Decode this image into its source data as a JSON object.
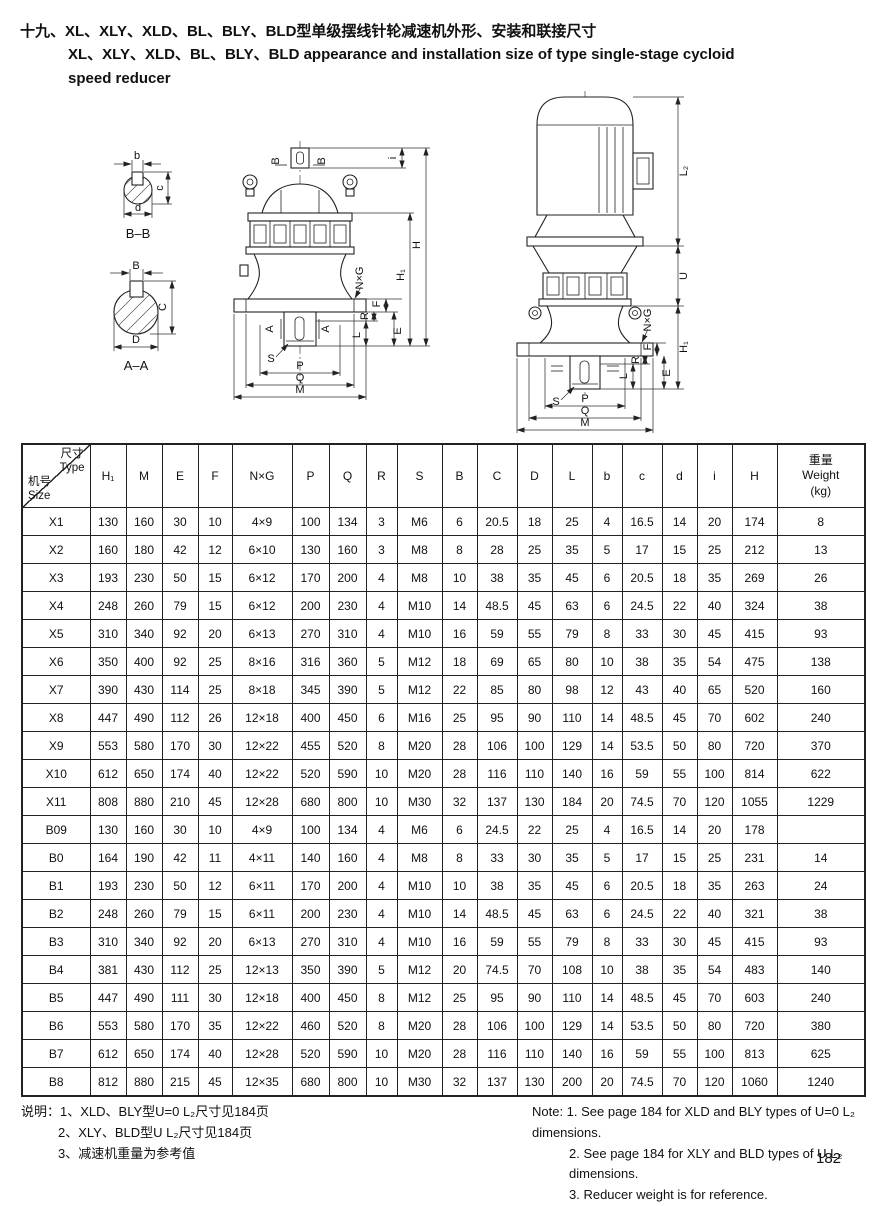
{
  "page": {
    "number": "182"
  },
  "title": {
    "zh": "十九、XL、XLY、XLD、BL、BLY、BLD型单级摆线针轮减速机外形、安装和联接尺寸",
    "en_line1": "XL、XLY、XLD、BL、BLY、BLD appearance and installation size of type single-stage cycloid",
    "en_line2": "speed reducer"
  },
  "drawings": {
    "bb_section": {
      "caption": "B–B",
      "dim_b": "b",
      "dim_c": "c",
      "dim_d": "d"
    },
    "aa_section": {
      "caption": "A–A",
      "dim_b": "B",
      "dim_c": "C",
      "dim_d": "D"
    },
    "reducer": {
      "mark_b": "B",
      "mark_a": "A",
      "dim_i": "i",
      "dim_h": "H",
      "dim_h1": "H₁",
      "dim_nxg": "N×G",
      "dim_f": "F",
      "dim_r": "R",
      "dim_e": "E",
      "dim_l": "L",
      "dim_s": "S",
      "dim_p": "P",
      "dim_q": "Q",
      "dim_m": "M"
    },
    "motor_reducer": {
      "dim_l2": "L₂",
      "dim_u": "U",
      "dim_h1": "H₁",
      "dim_nxg": "N×G",
      "dim_f": "F",
      "dim_r": "R",
      "dim_e": "E",
      "dim_l": "L",
      "dim_s": "S",
      "dim_p": "P",
      "dim_q": "Q",
      "dim_m": "M"
    }
  },
  "table": {
    "corner": {
      "top_zh": "尺寸",
      "top_en": "Type",
      "bottom_zh": "机号",
      "bottom_en": "Size"
    },
    "columns": [
      "H₁",
      "M",
      "E",
      "F",
      "N×G",
      "P",
      "Q",
      "R",
      "S",
      "B",
      "C",
      "D",
      "L",
      "b",
      "c",
      "d",
      "i",
      "H"
    ],
    "weight_header": [
      "重量",
      "Weight",
      "(kg)"
    ],
    "rows": [
      {
        "type": "X1",
        "values": [
          "130",
          "160",
          "30",
          "10",
          "4×9",
          "100",
          "134",
          "3",
          "M6",
          "6",
          "20.5",
          "18",
          "25",
          "4",
          "16.5",
          "14",
          "20",
          "174",
          "8"
        ]
      },
      {
        "type": "X2",
        "values": [
          "160",
          "180",
          "42",
          "12",
          "6×10",
          "130",
          "160",
          "3",
          "M8",
          "8",
          "28",
          "25",
          "35",
          "5",
          "17",
          "15",
          "25",
          "212",
          "13"
        ]
      },
      {
        "type": "X3",
        "values": [
          "193",
          "230",
          "50",
          "15",
          "6×12",
          "170",
          "200",
          "4",
          "M8",
          "10",
          "38",
          "35",
          "45",
          "6",
          "20.5",
          "18",
          "35",
          "269",
          "26"
        ]
      },
      {
        "type": "X4",
        "values": [
          "248",
          "260",
          "79",
          "15",
          "6×12",
          "200",
          "230",
          "4",
          "M10",
          "14",
          "48.5",
          "45",
          "63",
          "6",
          "24.5",
          "22",
          "40",
          "324",
          "38"
        ]
      },
      {
        "type": "X5",
        "values": [
          "310",
          "340",
          "92",
          "20",
          "6×13",
          "270",
          "310",
          "4",
          "M10",
          "16",
          "59",
          "55",
          "79",
          "8",
          "33",
          "30",
          "45",
          "415",
          "93"
        ]
      },
      {
        "type": "X6",
        "values": [
          "350",
          "400",
          "92",
          "25",
          "8×16",
          "316",
          "360",
          "5",
          "M12",
          "18",
          "69",
          "65",
          "80",
          "10",
          "38",
          "35",
          "54",
          "475",
          "138"
        ]
      },
      {
        "type": "X7",
        "values": [
          "390",
          "430",
          "114",
          "25",
          "8×18",
          "345",
          "390",
          "5",
          "M12",
          "22",
          "85",
          "80",
          "98",
          "12",
          "43",
          "40",
          "65",
          "520",
          "160"
        ]
      },
      {
        "type": "X8",
        "values": [
          "447",
          "490",
          "112",
          "26",
          "12×18",
          "400",
          "450",
          "6",
          "M16",
          "25",
          "95",
          "90",
          "110",
          "14",
          "48.5",
          "45",
          "70",
          "602",
          "240"
        ]
      },
      {
        "type": "X9",
        "values": [
          "553",
          "580",
          "170",
          "30",
          "12×22",
          "455",
          "520",
          "8",
          "M20",
          "28",
          "106",
          "100",
          "129",
          "14",
          "53.5",
          "50",
          "80",
          "720",
          "370"
        ]
      },
      {
        "type": "X10",
        "values": [
          "612",
          "650",
          "174",
          "40",
          "12×22",
          "520",
          "590",
          "10",
          "M20",
          "28",
          "116",
          "110",
          "140",
          "16",
          "59",
          "55",
          "100",
          "814",
          "622"
        ]
      },
      {
        "type": "X11",
        "values": [
          "808",
          "880",
          "210",
          "45",
          "12×28",
          "680",
          "800",
          "10",
          "M30",
          "32",
          "137",
          "130",
          "184",
          "20",
          "74.5",
          "70",
          "120",
          "1055",
          "1229"
        ]
      },
      {
        "type": "B09",
        "values": [
          "130",
          "160",
          "30",
          "10",
          "4×9",
          "100",
          "134",
          "4",
          "M6",
          "6",
          "24.5",
          "22",
          "25",
          "4",
          "16.5",
          "14",
          "20",
          "178",
          ""
        ]
      },
      {
        "type": "B0",
        "values": [
          "164",
          "190",
          "42",
          "11",
          "4×11",
          "140",
          "160",
          "4",
          "M8",
          "8",
          "33",
          "30",
          "35",
          "5",
          "17",
          "15",
          "25",
          "231",
          "14"
        ]
      },
      {
        "type": "B1",
        "values": [
          "193",
          "230",
          "50",
          "12",
          "6×11",
          "170",
          "200",
          "4",
          "M10",
          "10",
          "38",
          "35",
          "45",
          "6",
          "20.5",
          "18",
          "35",
          "263",
          "24"
        ]
      },
      {
        "type": "B2",
        "values": [
          "248",
          "260",
          "79",
          "15",
          "6×11",
          "200",
          "230",
          "4",
          "M10",
          "14",
          "48.5",
          "45",
          "63",
          "6",
          "24.5",
          "22",
          "40",
          "321",
          "38"
        ]
      },
      {
        "type": "B3",
        "values": [
          "310",
          "340",
          "92",
          "20",
          "6×13",
          "270",
          "310",
          "4",
          "M10",
          "16",
          "59",
          "55",
          "79",
          "8",
          "33",
          "30",
          "45",
          "415",
          "93"
        ]
      },
      {
        "type": "B4",
        "values": [
          "381",
          "430",
          "112",
          "25",
          "12×13",
          "350",
          "390",
          "5",
          "M12",
          "20",
          "74.5",
          "70",
          "108",
          "10",
          "38",
          "35",
          "54",
          "483",
          "140"
        ]
      },
      {
        "type": "B5",
        "values": [
          "447",
          "490",
          "111",
          "30",
          "12×18",
          "400",
          "450",
          "8",
          "M12",
          "25",
          "95",
          "90",
          "110",
          "14",
          "48.5",
          "45",
          "70",
          "603",
          "240"
        ]
      },
      {
        "type": "B6",
        "values": [
          "553",
          "580",
          "170",
          "35",
          "12×22",
          "460",
          "520",
          "8",
          "M20",
          "28",
          "106",
          "100",
          "129",
          "14",
          "53.5",
          "50",
          "80",
          "720",
          "380"
        ]
      },
      {
        "type": "B7",
        "values": [
          "612",
          "650",
          "174",
          "40",
          "12×28",
          "520",
          "590",
          "10",
          "M20",
          "28",
          "116",
          "110",
          "140",
          "16",
          "59",
          "55",
          "100",
          "813",
          "625"
        ]
      },
      {
        "type": "B8",
        "values": [
          "812",
          "880",
          "215",
          "45",
          "12×35",
          "680",
          "800",
          "10",
          "M30",
          "32",
          "137",
          "130",
          "200",
          "20",
          "74.5",
          "70",
          "120",
          "1060",
          "1240"
        ]
      }
    ]
  },
  "notes": {
    "zh": [
      "说明：1、XLD、BLY型U=0 L₂尺寸见184页",
      "2、XLY、BLD型U L₂尺寸见184页",
      "3、减速机重量为参考值"
    ],
    "en": [
      "Note: 1. See page 184 for XLD and BLY types of U=0 L₂ dimensions.",
      "2. See page 184 for XLY and BLD types of U L₂ dimensions.",
      "3. Reducer weight is for reference."
    ]
  }
}
